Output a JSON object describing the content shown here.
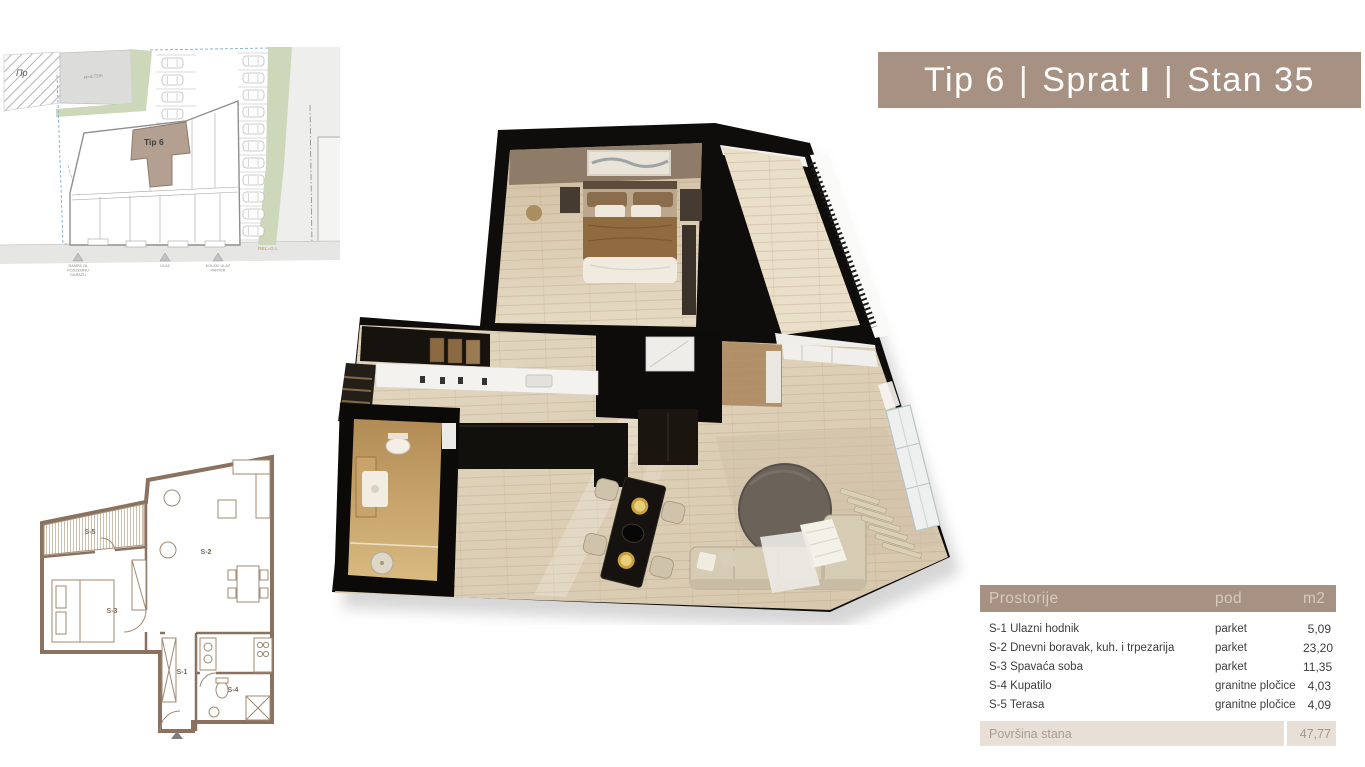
{
  "banner": {
    "unit_type": "Tip 6",
    "separator": "|",
    "floor_label": "Sprat",
    "floor_value": "I",
    "apartment": "Stan 35"
  },
  "site_plan": {
    "unit_highlight_label": "Tip 6",
    "zone_label": "Пр",
    "height_label": "H=4.72m",
    "regulation_label": "REL=G.L",
    "marker_garage": [
      "RAMPA ZA",
      "PODZEMNU",
      "GARAŽU"
    ],
    "marker_entrance": "ULAZ",
    "marker_vehicle": [
      "KOLSKI ULAZ",
      "PARTER"
    ]
  },
  "floor_plan_2d": {
    "room_labels": {
      "s1": "S-1",
      "s2": "S-2",
      "s3": "S-3",
      "s4": "S-4",
      "s5": "S-5"
    }
  },
  "table": {
    "headers": [
      "Prostorije",
      "pod",
      "m2"
    ],
    "rows": [
      {
        "name": "S-1 Ulazni hodnik",
        "pod": "parket",
        "m2": "5,09"
      },
      {
        "name": "S-2 Dnevni boravak, kuh. i trpezarija",
        "pod": "parket",
        "m2": "23,20"
      },
      {
        "name": "S-3 Spavaća soba",
        "pod": "parket",
        "m2": "11,35"
      },
      {
        "name": "S-4 Kupatilo",
        "pod": "granitne pločice",
        "m2": "4,03"
      },
      {
        "name": "S-5 Terasa",
        "pod": "granitne pločice",
        "m2": "4,09"
      }
    ],
    "footer": {
      "label": "Površina stana",
      "m2": "47,77"
    }
  },
  "theme": {
    "banner_bg": "#a79183",
    "header_text": "#d6cabd",
    "footer_bg": "#e8e0d7",
    "footer_text": "#aa9b8d",
    "row_text": "#3d3d3d",
    "wall_black": "#0e0d0c",
    "wall_brown_2d": "#8a7160",
    "wood_light": "#ddd0ba",
    "green_area": "#ccd8b9",
    "regulation_orange": "#d9825f"
  }
}
